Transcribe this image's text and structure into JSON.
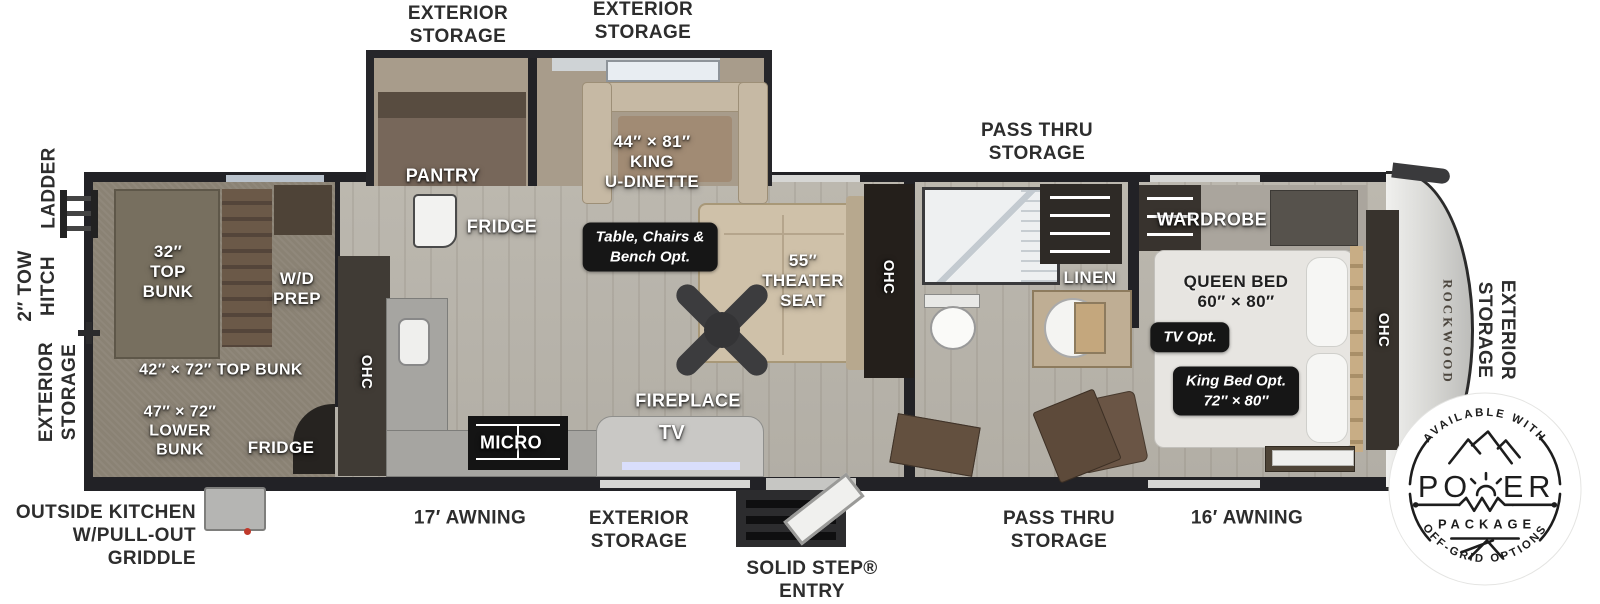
{
  "colors": {
    "wall": "#222226",
    "floor": "#b7b3aa",
    "carpet": "#8a8274",
    "bench_tan": "#c6b9a4",
    "cabinet_brown": "#77675a",
    "option_box": "#161616",
    "badge_ink": "#1d1d1d"
  },
  "ext": {
    "ladder": "LADDER",
    "tow_hitch": "2″ TOW\nHITCH",
    "storage_left": "EXTERIOR\nSTORAGE",
    "storage_top_a": "EXTERIOR\nSTORAGE",
    "storage_top_b": "EXTERIOR\nSTORAGE",
    "pass_thru_top": "PASS THRU\nSTORAGE",
    "storage_right": "EXTERIOR\nSTORAGE",
    "outside_kitchen": "OUTSIDE KITCHEN\nW/PULL-OUT\nGRIDDLE",
    "awning_17": "17′ AWNING",
    "storage_bottom": "EXTERIOR\nSTORAGE",
    "solid_step": "SOLID STEP®\nENTRY",
    "pass_thru_bottom": "PASS THRU\nSTORAGE",
    "awning_16": "16′ AWNING"
  },
  "rooms": {
    "bunk32": "32″\nTOP\nBUNK",
    "wd_prep": "W/D\nPREP",
    "bunk42": "42″ × 72″ TOP BUNK",
    "bunk47": "47″ × 72″\nLOWER\nBUNK",
    "bunk_fridge": "FRIDGE",
    "pantry": "PANTRY",
    "kitchen_fridge": "FRIDGE",
    "dinette": "44″ × 81″\nKING\nU-DINETTE",
    "dinette_opt": "Table, Chairs &\nBench Opt.",
    "ohc_kitchen": "OHC",
    "micro": "MICRO",
    "fireplace": "FIREPLACE",
    "tv": "TV",
    "theater": "55″\nTHEATER\nSEAT",
    "ohc_living": "OHC",
    "linen": "LINEN",
    "wardrobe": "WARDROBE",
    "queen": "QUEEN BED\n60″ × 80″",
    "tv_opt": "TV Opt.",
    "king_opt": "King Bed Opt.\n72″ × 80″",
    "ohc_bedroom": "OHC",
    "brand": "ROCKWOOD"
  },
  "badge": {
    "top_arc": "AVAILABLE WITH",
    "power_left": "PO",
    "power_right": "ER",
    "package": "PACKAGE",
    "bottom_arc": "OFF-GRID OPTIONS"
  }
}
